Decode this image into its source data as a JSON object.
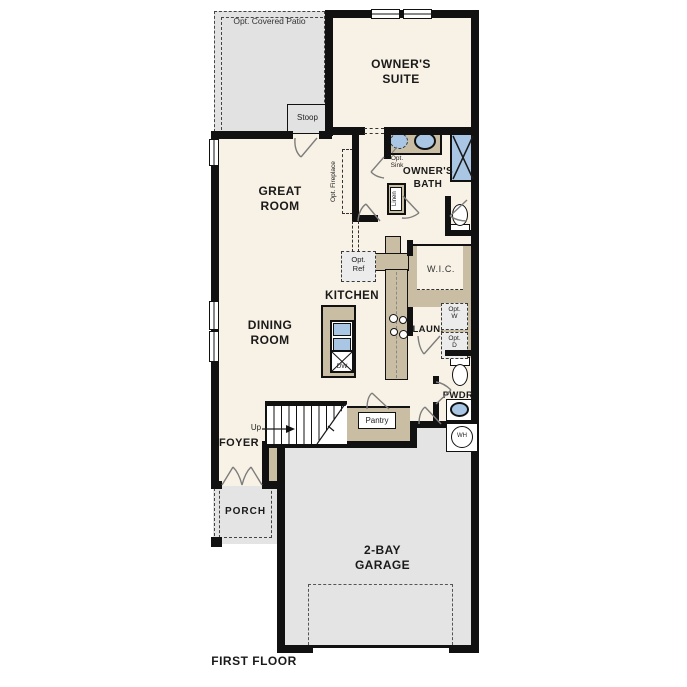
{
  "plan_title": "FIRST FLOOR",
  "colors": {
    "wall": "#111111",
    "floor": "#f8f1e5",
    "outdoor_gray": "#e4e4e4",
    "stoop_gray": "#e2e2e2",
    "counter_tan": "#c9bda4",
    "fixture_blue": "#a9c7e5",
    "optional_fill": "#ececec"
  },
  "labels": {
    "patio": "Opt. Covered Patio",
    "owners_suite": "OWNER'S\nSUITE",
    "stoop": "Stoop",
    "great_room": "GREAT\nROOM",
    "opt_fireplace": "Opt. Fireplace",
    "opt_sink": "Opt.\nSink",
    "owners_bath": "OWNER'S\nBATH",
    "linen": "Linen",
    "wic": "W.I.C.",
    "opt_ref": "Opt.\nRef",
    "kitchen": "KITCHEN",
    "dining_room": "DINING\nROOM",
    "laundry": "LAUN.",
    "opt_washer": "Opt.\nW",
    "opt_dryer": "Opt.\nD",
    "pwdr": "PWDR",
    "water_heater": "WH",
    "dishwasher": "DW",
    "up": "Up",
    "pantry": "Pantry",
    "foyer": "FOYER",
    "porch": "PORCH",
    "garage": "2-BAY\nGARAGE",
    "first_floor": "FIRST FLOOR"
  }
}
